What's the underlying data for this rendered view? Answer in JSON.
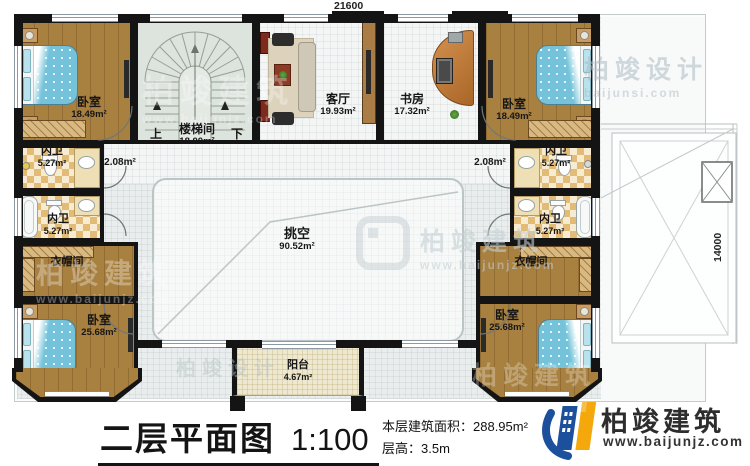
{
  "dimensions": {
    "top": "21600",
    "right": "14000"
  },
  "rooms": {
    "bedroom_tl": {
      "name": "卧室",
      "area": "18.49m²"
    },
    "bedroom_tr": {
      "name": "卧室",
      "area": "18.49m²"
    },
    "stair": {
      "name": "楼梯间",
      "area": "18.00m²",
      "up": "上",
      "down": "下"
    },
    "living": {
      "name": "客厅",
      "area": "19.93m²"
    },
    "study": {
      "name": "书房",
      "area": "17.32m²"
    },
    "bath_l1": {
      "name": "内卫",
      "area": "5.27m²"
    },
    "bath_l2": {
      "name": "内卫",
      "area": "5.27m²"
    },
    "bath_r1": {
      "name": "内卫",
      "area": "5.27m²"
    },
    "bath_r2": {
      "name": "内卫",
      "area": "5.27m²"
    },
    "hall_l": {
      "area": "2.08m²"
    },
    "hall_r": {
      "area": "2.08m²"
    },
    "void": {
      "name": "挑空",
      "area": "90.52m²"
    },
    "cloak_l": {
      "name": "衣帽间"
    },
    "cloak_r": {
      "name": "衣帽间"
    },
    "bedroom_bl": {
      "name": "卧室",
      "area": "25.68m²"
    },
    "bedroom_br": {
      "name": "卧室",
      "area": "25.68m²"
    },
    "balcony": {
      "name": "阳台",
      "area": "4.67m²"
    }
  },
  "title": {
    "plan": "二层平面图",
    "scale": "1:100",
    "building_area": "本层建筑面积：288.95m²",
    "floor_height": "层高：3.5m"
  },
  "branding": {
    "company": "柏竣建筑",
    "website": "www.baijunjz.com"
  },
  "watermarks": {
    "design": "柏竣设计",
    "design_url": "baijunsi.com",
    "build": "柏竣建筑",
    "build_url": "www.baijunjz.com"
  },
  "colors": {
    "wall": "#141414",
    "wood_floor": "#a8803f",
    "bed_blue": "#74c3da",
    "bath_checker": "#e2bb77",
    "stair_floor": "#dde3dd",
    "balcony_floor": "#efe8d0",
    "logo_blue": "#1c4f9c",
    "logo_orange": "#f5a80c"
  }
}
